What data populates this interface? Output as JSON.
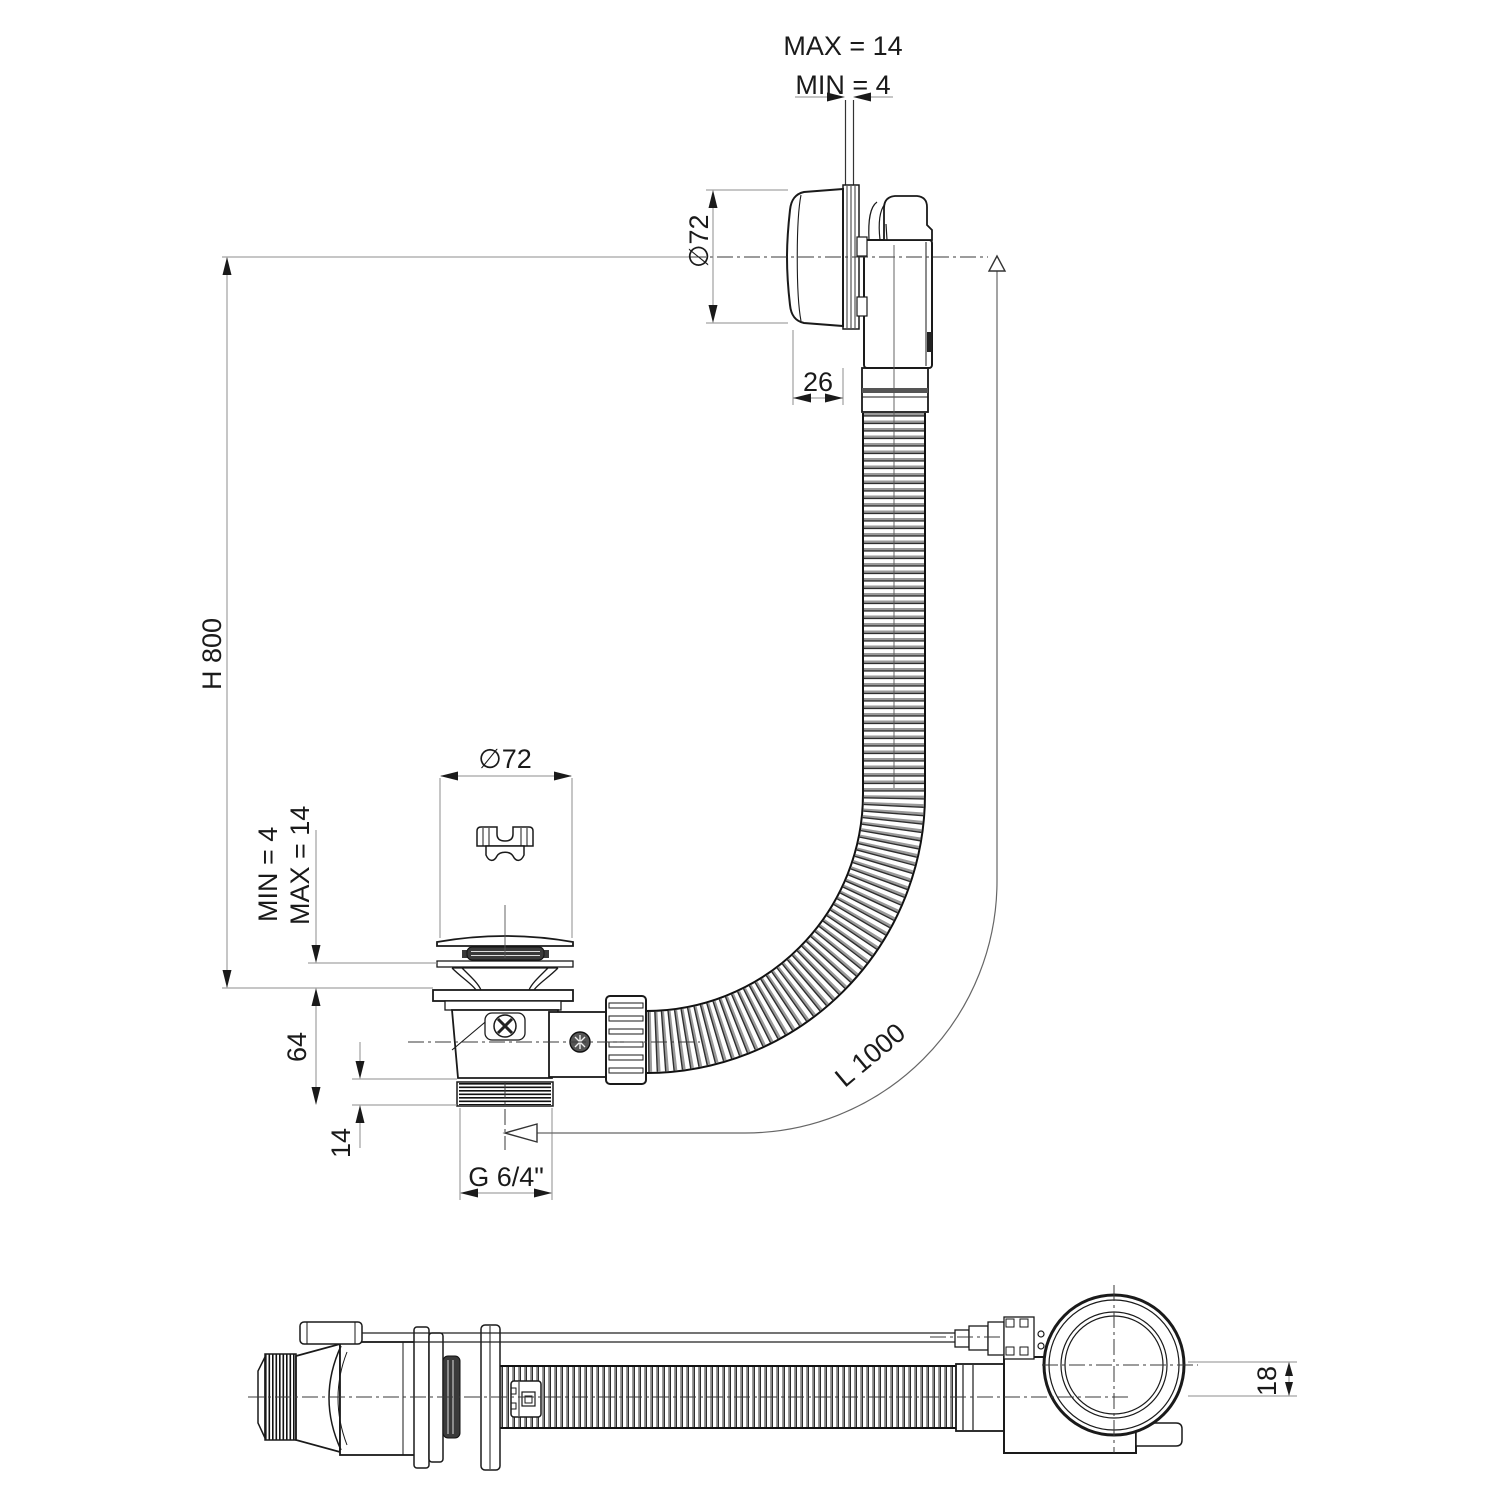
{
  "drawing": {
    "type": "technical-drawing",
    "background": "#ffffff",
    "line_color": "#1a1a1a",
    "dimension_line_color": "#8c8c8c",
    "labels": {
      "overflow_wall_max": "MAX = 14",
      "overflow_wall_min": "MIN =  4",
      "overflow_diameter": "∅72",
      "overflow_knob_depth": "26",
      "install_height": "H 800",
      "drain_diameter": "∅72",
      "tub_bottom_min": "MIN = 4",
      "tub_bottom_max": "MAX = 14",
      "drain_body_height": "64",
      "thread_length": "14",
      "thread_size": "G 6/4\"",
      "hose_length": "L 1000",
      "axis_offset": "18"
    }
  }
}
